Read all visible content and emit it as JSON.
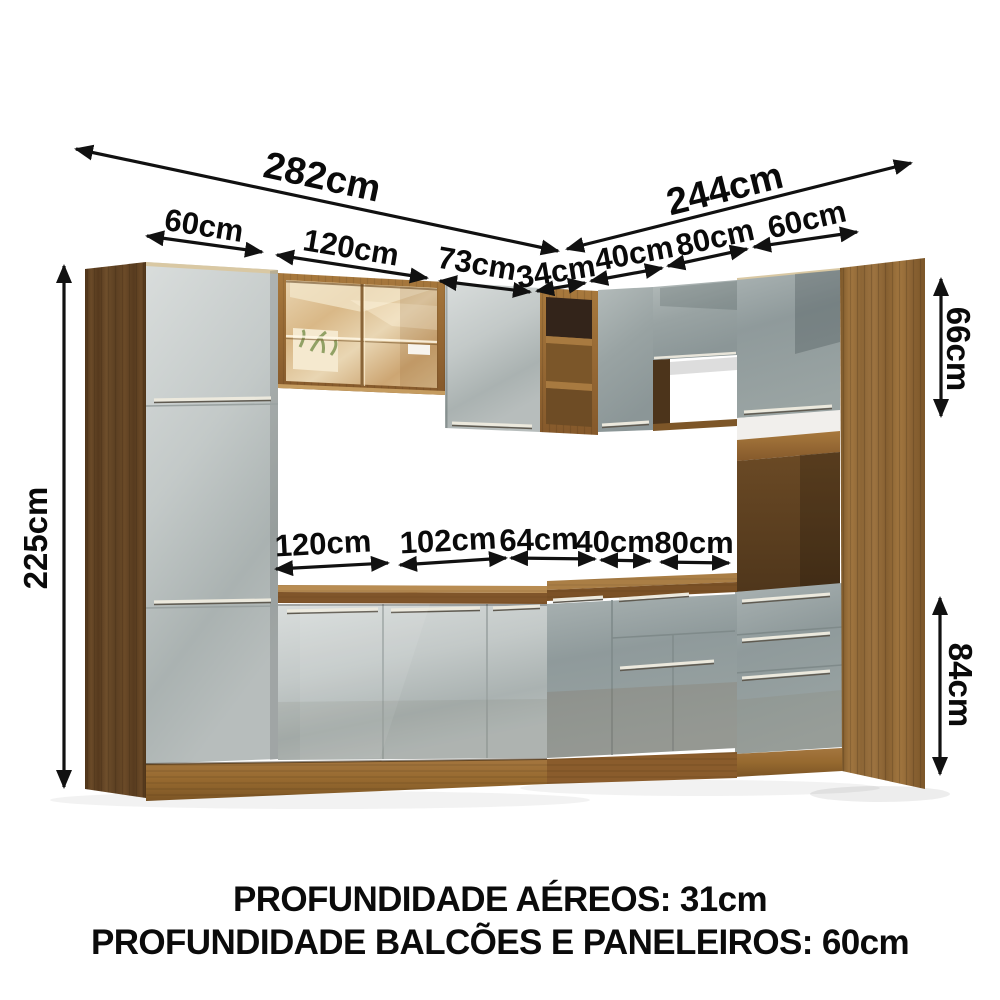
{
  "dims": {
    "total_left": "282cm",
    "total_right": "244cm",
    "top_60_left": "60cm",
    "top_120": "120cm",
    "top_73": "73cm",
    "top_34": "34cm",
    "top_40": "40cm",
    "top_80": "80cm",
    "top_60_right": "60cm",
    "height_total": "225cm",
    "height_upper": "66cm",
    "height_base": "84cm",
    "mid_120": "120cm",
    "mid_102": "102cm",
    "mid_64": "64cm",
    "mid_40": "40cm",
    "mid_80": "80cm"
  },
  "footer": {
    "line1": "PROFUNDIDADE AÉREOS: 31cm",
    "line2": "PROFUNDIDADE BALCÕES E PANELEIROS: 60cm"
  },
  "colors": {
    "arrow": "#111111",
    "wood_dark_side": "#5f4226",
    "wood_light_side": "#96703b",
    "wood_frame": "#9a6f38",
    "door_gray_light": "#c6cccb",
    "door_gray_dark": "#97a1a1",
    "glass_amber": "#dcbd90",
    "background": "#ffffff"
  }
}
